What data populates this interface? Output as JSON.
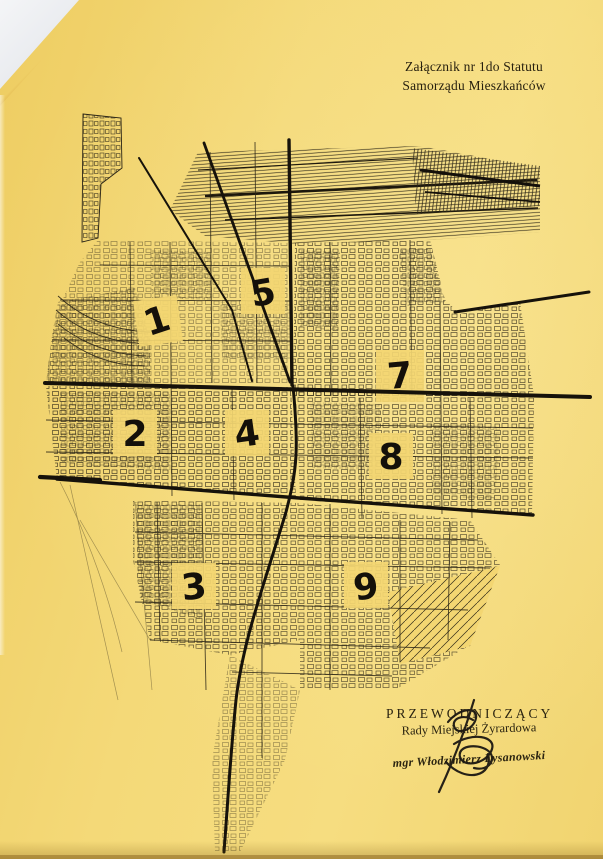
{
  "header": {
    "line1": "Załącznik nr 1do Statutu",
    "line2": "Samorządu Mieszkańców"
  },
  "map": {
    "districts": [
      {
        "label": "1"
      },
      {
        "label": "2"
      },
      {
        "label": "3"
      },
      {
        "label": "4"
      },
      {
        "label": "5"
      },
      {
        "label": "7"
      },
      {
        "label": "8"
      },
      {
        "label": "9"
      }
    ]
  },
  "footer": {
    "role_line1": "PRZEWODNICZĄCY",
    "role_line2": "Rady Miejskiej Żyrardowa",
    "signer": "mgr Włodzimierz Łysanowski"
  },
  "colors": {
    "paper": "#f3d672",
    "map_ink": "#2b2516",
    "boundary_ink": "#16120a",
    "corner_white": "#e9ebee"
  }
}
